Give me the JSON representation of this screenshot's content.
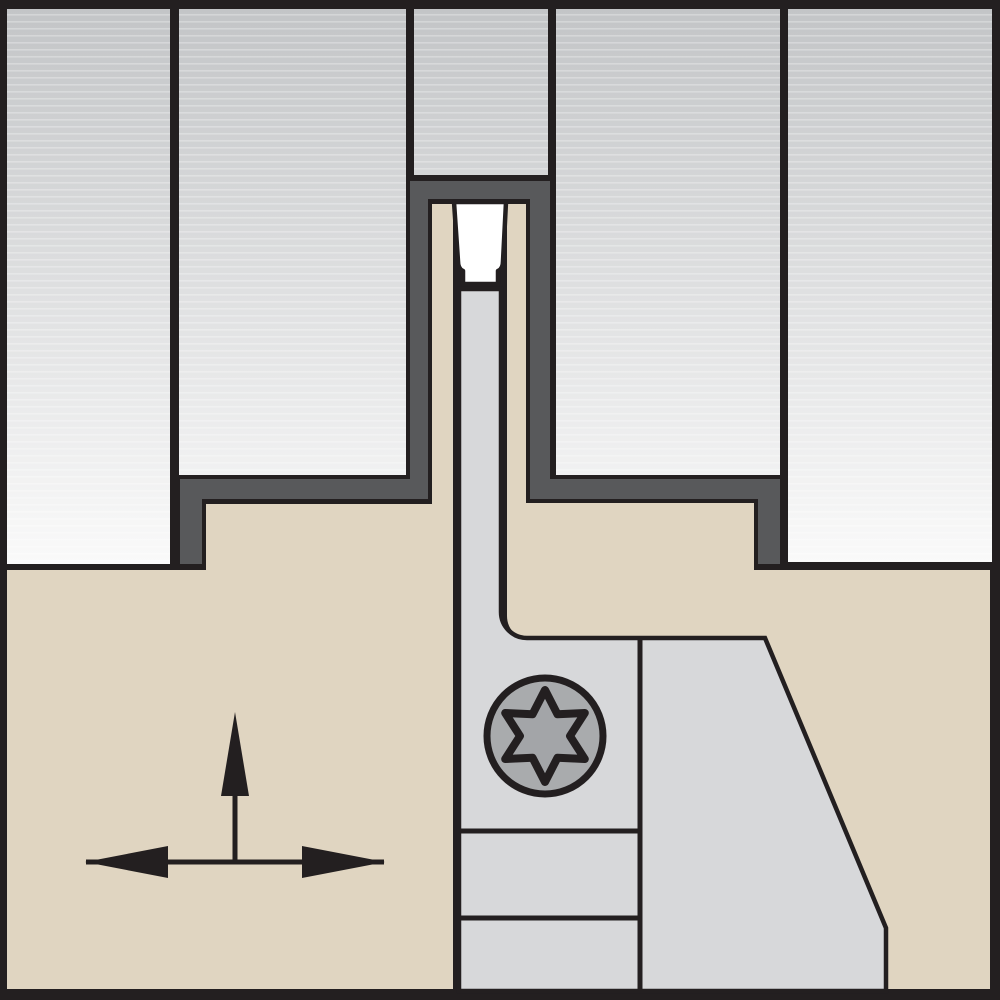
{
  "diagram": {
    "type": "tool-cross-section",
    "parts": {
      "workpiece": "workpiece-material",
      "groove": "machined-groove-surface",
      "tool_body": "tool-shank-cross-section",
      "insert": "grooving-insert",
      "holder": "blade-holder-front",
      "screw": "clamp-screw",
      "arrows": "feed-direction-arrows"
    },
    "icons": {
      "screw_drive": "torx-icon",
      "up_arrow": "arrow-up-icon",
      "left_right_arrow": "arrow-left-right-icon"
    }
  },
  "colors": {
    "outline": "#231f20",
    "workpiece_top": "#c3c5c7",
    "workpiece_bottom": "#fafafa",
    "groove_surface": "#58595b",
    "tool_body": "#e0d5c1",
    "holder": "#d7d8da",
    "insert": "#ffffff",
    "screw": "#a9abad",
    "screw_star": "#a3a5a8",
    "arrow": "#231f20"
  }
}
